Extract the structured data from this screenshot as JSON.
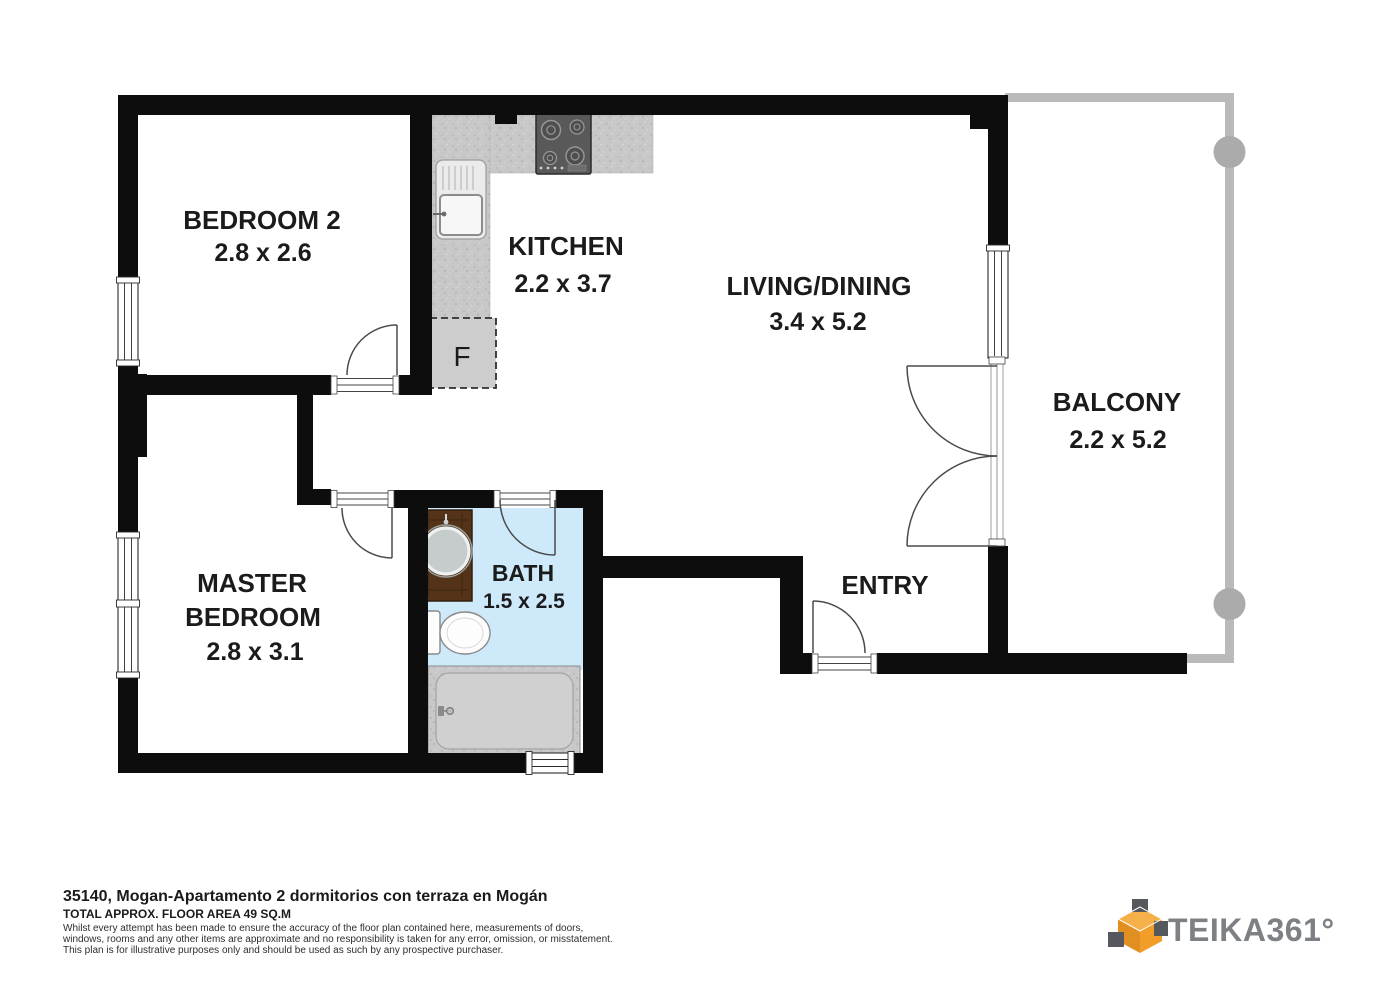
{
  "floorplan": {
    "rooms": {
      "bedroom2": {
        "name": "BEDROOM 2",
        "dims": "2.8 x 2.6"
      },
      "kitchen": {
        "name": "KITCHEN",
        "dims": "2.2 x 3.7"
      },
      "living": {
        "name": "LIVING/DINING",
        "dims": "3.4 x 5.2"
      },
      "balcony": {
        "name": "BALCONY",
        "dims": "2.2 x 5.2"
      },
      "master": {
        "line1": "MASTER",
        "line2": "BEDROOM",
        "dims": "2.8 x 3.1"
      },
      "bath": {
        "name": "BATH",
        "dims": "1.5 x 2.5"
      },
      "entry": {
        "name": "ENTRY"
      }
    },
    "fixtures": {
      "fridge_label": "F"
    }
  },
  "footer": {
    "title": "35140, Mogan-Apartamento 2 dormitorios con terraza en Mogán",
    "area": "TOTAL APPROX. FLOOR AREA 49 SQ.M",
    "disclaimer": [
      "Whilst every attempt has been made to ensure the accuracy of the floor plan contained here, measurements of doors,",
      "windows, rooms and any other items are approximate and no responsibility is taken for any error, omission, or misstatement.",
      "This plan is for illustrative purposes only and should be used as such by any prospective purchaser."
    ]
  },
  "logo": {
    "text": "TEIKA361°"
  },
  "colors": {
    "wall": "#0d0d0d",
    "counter": "#c8c8c8",
    "bath_floor": "#cde9fa",
    "vanity_wood": "#543318",
    "railing": "#bababa",
    "logo_orange": "#f2a339",
    "logo_gray": "#7d8185"
  }
}
